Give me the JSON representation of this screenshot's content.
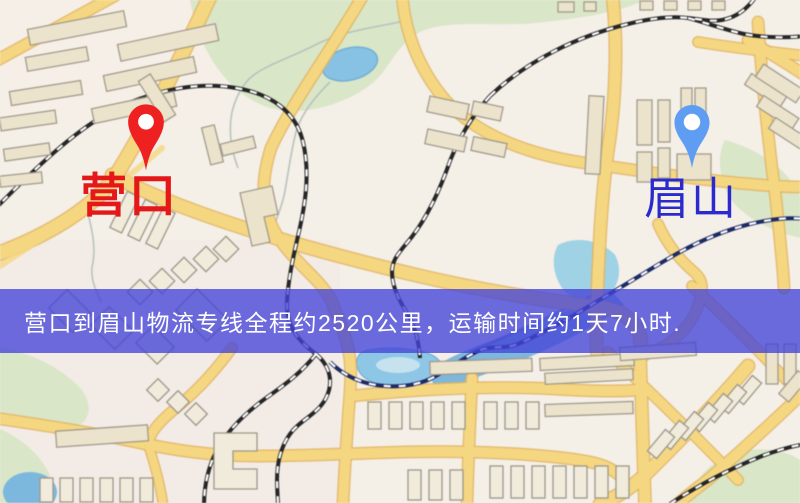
{
  "markers": {
    "origin": {
      "name": "营口",
      "label_color": "#e41818",
      "pin_color": "#ee2020",
      "pin_icon": "map-pin"
    },
    "destination": {
      "name": "眉山",
      "label_color": "#2a2ace",
      "pin_color": "#5f9df2",
      "pin_icon": "map-pin"
    }
  },
  "banner": {
    "text": "营口到眉山物流专线全程约2520公里，运输时间约1天7小时.",
    "background_color": "rgba(68,68,216,0.78)",
    "text_color": "#ffffff"
  },
  "map_theme": {
    "background": "#f4efe7",
    "road_fill": "#f6d77e",
    "road_casing": "#e3b45c",
    "building_fill": "#ece3cb",
    "green_area": "#d9e6c6",
    "water": "#8cc6e8",
    "railway": "#262626"
  }
}
